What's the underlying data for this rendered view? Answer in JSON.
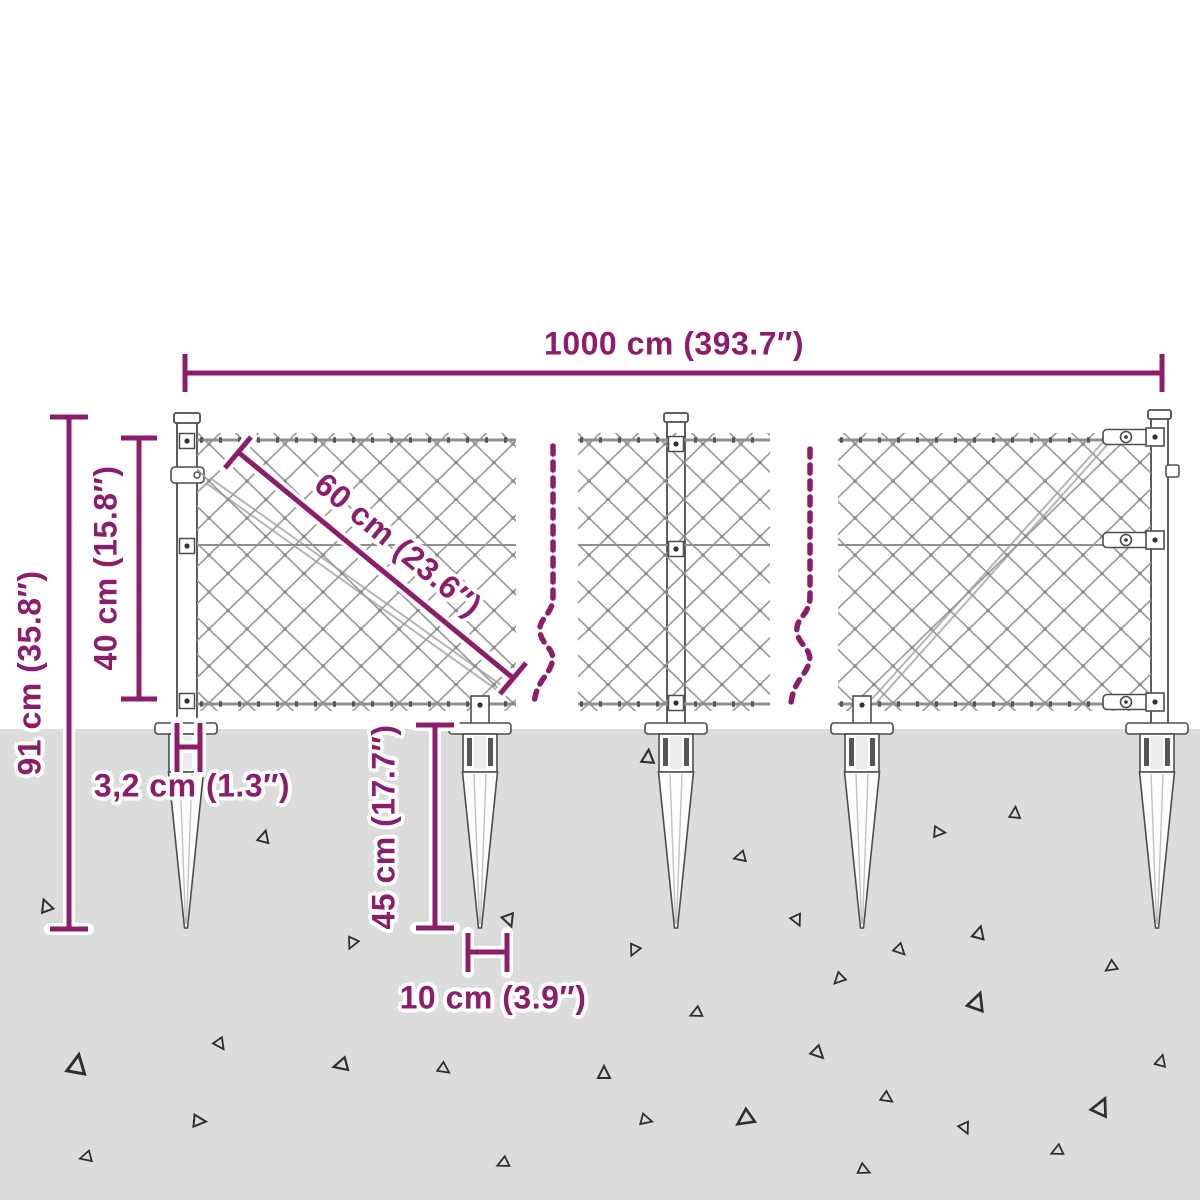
{
  "diagram": {
    "subject": "chain-link-fence-with-spike-anchors-dimension-diagram",
    "accent_color": "#8b1d6b",
    "ground_color": "#dcdcdc",
    "outline_color": "#4d4d4d",
    "mesh_color": "#9a9a9a",
    "dims": {
      "d1000": {
        "label": "1000 cm (393.7″)",
        "cm": 1000,
        "inch": 393.7
      },
      "d91": {
        "label": "91 cm (35.8″)",
        "cm": 91,
        "inch": 35.8
      },
      "d40": {
        "label": "40 cm (15.8″)",
        "cm": 40,
        "inch": 15.8
      },
      "d60": {
        "label": "60 cm (23.6″)",
        "cm": 60,
        "inch": 23.6
      },
      "d32": {
        "label": "3,2 cm (1.3″)",
        "cm": 3.2,
        "inch": 1.3
      },
      "d45": {
        "label": "45 cm (17.7″)",
        "cm": 45,
        "inch": 17.7
      },
      "d10": {
        "label": "10 cm (3.9″)",
        "cm": 10,
        "inch": 3.9
      }
    }
  }
}
